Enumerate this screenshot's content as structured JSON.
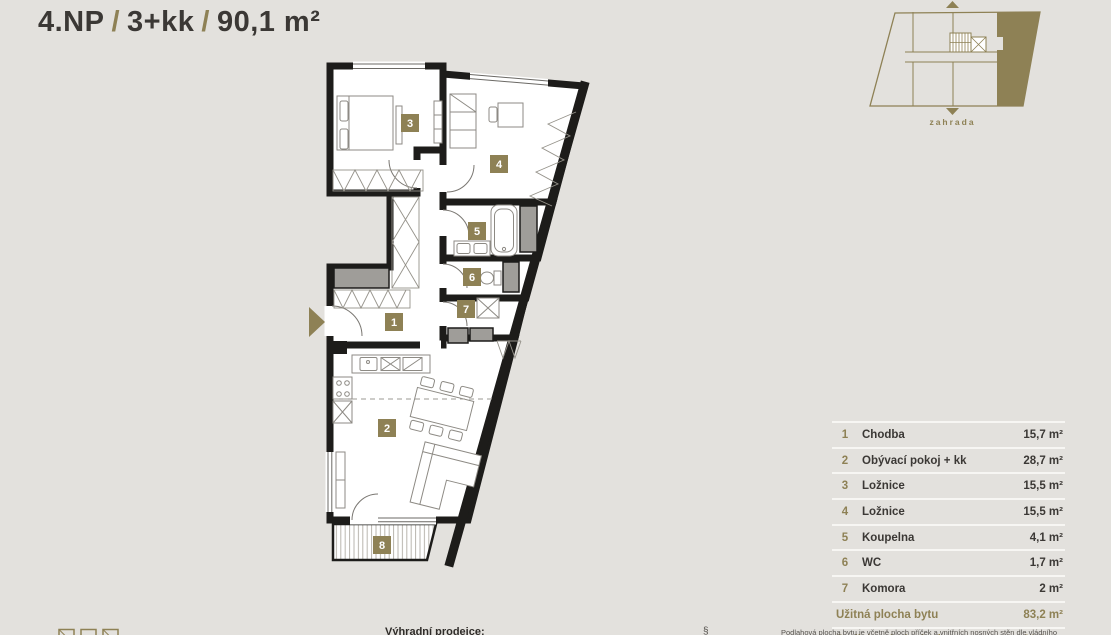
{
  "title": {
    "floor": "4.NP",
    "separator": "/",
    "layout": "3+kk",
    "area": "90,1 m²"
  },
  "minimap": {
    "garden_label": "zahrada"
  },
  "plan": {
    "terrace_badge": "8"
  },
  "legend": {
    "rooms": [
      {
        "num": "1",
        "name": "Chodba",
        "area": "15,7 m²"
      },
      {
        "num": "2",
        "name": "Obývací pokoj + kk",
        "area": "28,7 m²"
      },
      {
        "num": "3",
        "name": "Ložnice",
        "area": "15,5 m²"
      },
      {
        "num": "4",
        "name": "Ložnice",
        "area": "15,5 m²"
      },
      {
        "num": "5",
        "name": "Koupelna",
        "area": "4,1 m²"
      },
      {
        "num": "6",
        "name": "WC",
        "area": "1,7 m²"
      },
      {
        "num": "7",
        "name": "Komora",
        "area": "2 m²"
      }
    ],
    "summary": [
      {
        "label": "Užitná plocha bytu",
        "area": "83,2 m²"
      },
      {
        "label": "Podlahová plocha bytu",
        "area": "90,1 m²"
      }
    ]
  },
  "footer": {
    "seller_label": "Výhradní prodejce:",
    "paragraph_symbol": "§",
    "disclaimer": "Podlahová plocha bytu je včetně ploch příček a vnitřních nosných stěn dle vládního"
  },
  "colors": {
    "accent": "#8e8155",
    "text_dark": "#3b3835",
    "background": "#e3e1dd",
    "wall": "#1d1c1a"
  }
}
